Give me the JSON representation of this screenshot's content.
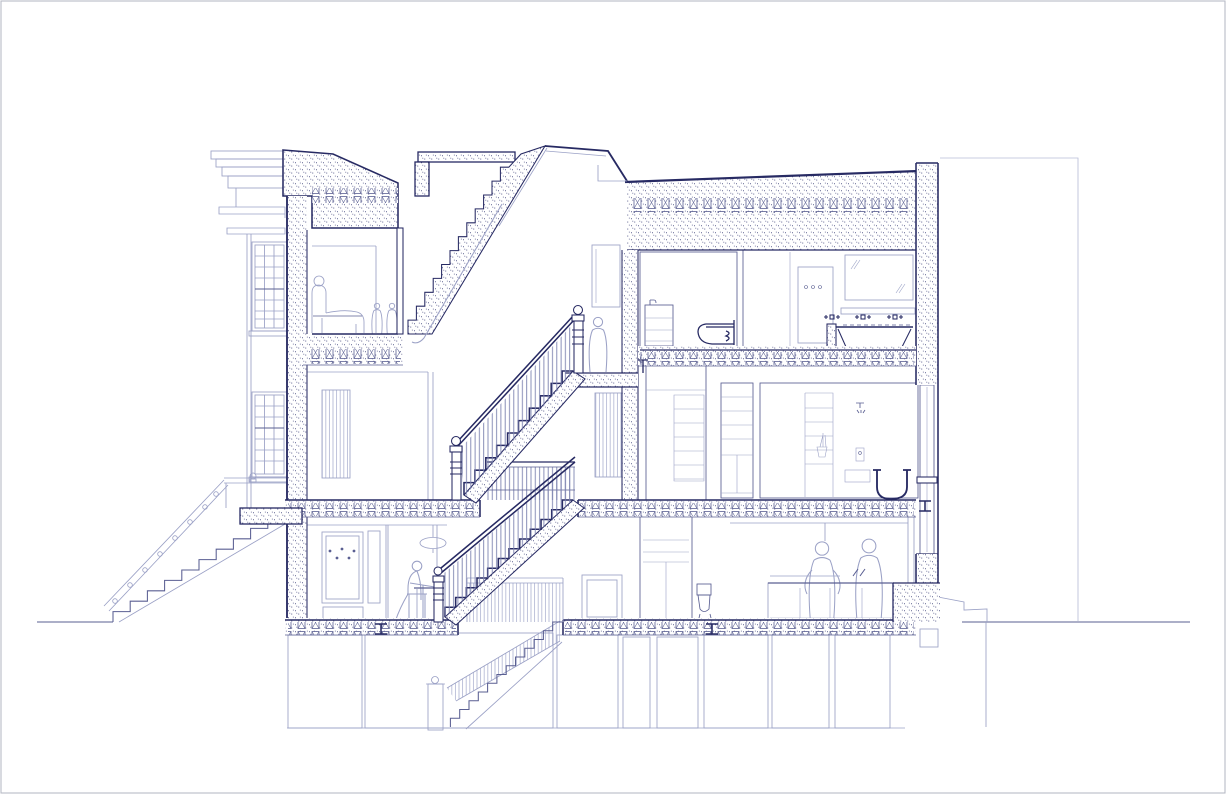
{
  "page": {
    "kind": "architectural-section-drawing",
    "visible_text": ""
  },
  "colors": {
    "ink": "#272a63",
    "mid": "#5a5f92",
    "light": "#9ba1c6",
    "faint": "#b9bed9",
    "balusters": "#7d83b0",
    "stipple_dot": "#3d4178",
    "background": "#ffffff",
    "frame": "#b5b7c3"
  },
  "drawing": {
    "type": "building-cross-section",
    "levels": [
      "cellar",
      "garden-level",
      "parlor-level",
      "top-floor",
      "roof-bulkhead"
    ],
    "elements": [
      "page-frame",
      "street-ground-line",
      "garden-ground-line",
      "neighbor-outline",
      "front-cornice",
      "front-facade-window-upper",
      "front-facade-window-lower",
      "stoop-steps",
      "stoop-railing",
      "stoop-landing-slab",
      "front-wall-cut",
      "rear-wall-cut",
      "center-wall-cut",
      "roof-front-cut",
      "stair-bulkhead",
      "skylight-slope",
      "rear-roof-band",
      "floor-bands-with-joists",
      "flight-to-roof",
      "flight-parlor-to-top",
      "flight-garden-to-parlor",
      "basement-stair",
      "landing-balustrade",
      "garden-stair-guard",
      "newel-posts",
      "top-front-room",
      "chaise-with-figure",
      "standing-figures",
      "landing-figure",
      "small-bathroom",
      "wall-hung-toilet",
      "washstand-cabinet",
      "main-bathroom",
      "mirror-cabinet",
      "faucet-trio",
      "vanity-ledge",
      "built-in-bathtub",
      "shower-panel",
      "closet-shelving",
      "bedroom-bathroom",
      "shower-head",
      "freestanding-bathtub",
      "rear-sash-window",
      "parlor-room",
      "radiator-panel",
      "hall-radiator-panel",
      "garden-room",
      "coat-hook-panel",
      "pendant-lamp",
      "seated-figure",
      "side-table",
      "wardrobe",
      "garden-toilet",
      "kitchen",
      "kitchen-island",
      "kitchen-figures",
      "rear-glazed-door",
      "garden-rear-step",
      "cellar-piers",
      "cellar-floor-line",
      "steel-beam-symbols",
      "footing-block"
    ]
  }
}
